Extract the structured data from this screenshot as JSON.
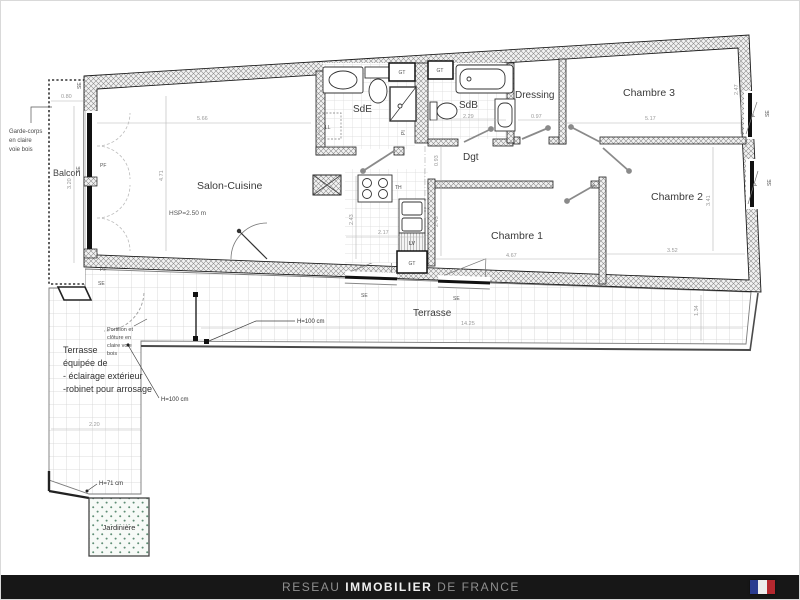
{
  "footer": {
    "brand_prefix": "RESEAU",
    "brand_main": "IMMOBILIER",
    "brand_suffix": "DE FRANCE",
    "bg": "#171717",
    "flag": {
      "blue": "#2a3c8f",
      "white": "#ededed",
      "red": "#b5282f"
    }
  },
  "rooms": {
    "balcon": "Balcon",
    "salon": "Salon-Cuisine",
    "salon_height": "HSP=2.50 m",
    "sde": "SdE",
    "sdb": "SdB",
    "dressing": "Dressing",
    "degagement": "Dgt",
    "chambre1": "Chambre 1",
    "chambre2": "Chambre 2",
    "chambre3": "Chambre 3",
    "terrasse": "Terrasse",
    "jardiniere": "Jardinière"
  },
  "annotations": {
    "garde_corps": [
      "Garde-corps",
      "en claire",
      "voie bois"
    ],
    "portillon": [
      "Portillon et",
      "clôture en",
      "claire voie",
      "bois"
    ],
    "terrasse_equipment": [
      "Terrasse",
      "équipée de",
      "- éclairage extérieur",
      "-robinet pour arrosage"
    ],
    "h100": "H=100 cm",
    "h71": "H=71 cm"
  },
  "openings": {
    "pf": "PF",
    "f": "F",
    "se": "SE",
    "gt": "GT",
    "ll": "LL",
    "lv": "LV",
    "pi": "PI",
    "th": "TH"
  },
  "dimensions": {
    "balcon_width": "0.80",
    "balcon_length": "3.20",
    "salon_width": "5.66",
    "salon_length": "4.71",
    "kitchen_width": "2.17",
    "kitchen_depth": "2.43",
    "sdb_width": "2.29",
    "dressing_width": "0.97",
    "dgt_width": "0.93",
    "chambre1_width": "4.67",
    "chambre1_depth": "2.43",
    "chambre2_width": "3.52",
    "chambre2_depth": "3.41",
    "chambre3_width": "5.17",
    "chambre3_depth": "2.47",
    "terrasse_length": "14.25",
    "terrasse_depth": "1.34",
    "terrasse_left_width": "2.20"
  }
}
